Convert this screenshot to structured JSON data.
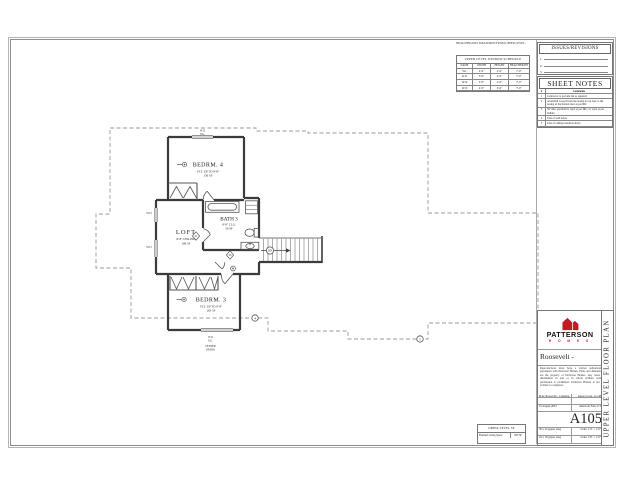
{
  "colors": {
    "accent_red": "#c41a22",
    "line_dark": "#3b3b3b",
    "line_dash": "#9a9a9a"
  },
  "window_schedule": {
    "note": "HEAD HEIGHTS MEASURED FROM UPPER LEVEL.",
    "title": "UPPER LEVEL WINDOW SCHEDULE",
    "col_name": "NAME",
    "col_width": "WIDTH",
    "col_height": "HEIGHT",
    "col_head": "HEAD HEIGHT",
    "rows": [
      [
        "W1",
        "2'-0\"",
        "2'-0\"",
        "7'-0\""
      ],
      [
        "W11",
        "3'-0\"",
        "4'-0\"",
        "7'-0\""
      ],
      [
        "W12",
        "3'-0\"",
        "2'-0\"",
        "7'-0\""
      ],
      [
        "W13",
        "2'-0\"",
        "3'-0\"",
        "7'-0\""
      ]
    ]
  },
  "issues": {
    "title": "ISSUES/REVISIONS",
    "rows": [
      "1.",
      "2.",
      "3."
    ]
  },
  "sheet_notes": {
    "title": "SHEET NOTES",
    "col_num": "#",
    "col_comments": "Comments",
    "rows": [
      [
        "1",
        "Contractor to provide fan as required"
      ],
      [
        "2",
        "A handrail is req'd from the nosing at top riser to the nosing of the bottom riser as per IRC"
      ],
      [
        "3",
        "36\" min. guardrail is req'd as per IRC, w/ style as per builder"
      ],
      [
        "4",
        "Line of wall below"
      ],
      [
        "5",
        "Line of ceiling transition above"
      ]
    ]
  },
  "title_block": {
    "brand_name": "PATTERSON",
    "brand_sub": "H O M E S",
    "plan_title": "Roosevelt - Contemp.",
    "disclaimer": "Reproductions must have a written authorization agreement with Patterson Homes. Plans and dimensions are the property of Patterson Homes. Any reuse or distribution in part or in whole without written permission is prohibited. Patterson Homes is not an architect or engineer.",
    "plan_line": "Plan: Roosevelt - Contemp.",
    "lot_line": "Aurora Crest, Lot 48",
    "date": "10 August 2023",
    "city": "American Fork, UT",
    "sheet_number": "A105",
    "paper1": "36 x 24 (paper size)",
    "scale1": "Scale: 1/4\" = 1'-0\"",
    "paper2": "24 x 18 (paper size)",
    "scale2": "Scale: 1/8\" = 1'-0\"",
    "sheet_title": "UPPER LEVEL FLOOR PLAN"
  },
  "sf_table": {
    "title": "UPPER LEVEL SF",
    "row_label": "Finished Living Space",
    "row_value": "903 SF"
  },
  "plan": {
    "bedrm4": {
      "name": "BEDRM. 4",
      "sub": "VLT. UP TO 9'-8\"",
      "sf": "156 SF"
    },
    "loft": {
      "name": "LOFT",
      "sub": "8'-8\" CEILING",
      "sf": "166 SF"
    },
    "bath3": {
      "name": "BATH 3",
      "sub": "8'-8\" CLG.",
      "sf": "56 SF"
    },
    "bedrm3": {
      "name": "BEDRM. 3",
      "sub": "VLT. UP TO 9'-8\"",
      "sf": "163 SF"
    },
    "tags": {
      "w12": "W12",
      "w12b": "EG.",
      "w13a": "W13",
      "w13b": "W13",
      "w11": "W11",
      "w11b": "EG.",
      "center1": "CENTER",
      "center2": "ON RM.",
      "dn": "DN",
      "door21": "21",
      "door26": "26",
      "note4": "4",
      "note5": "5"
    }
  }
}
